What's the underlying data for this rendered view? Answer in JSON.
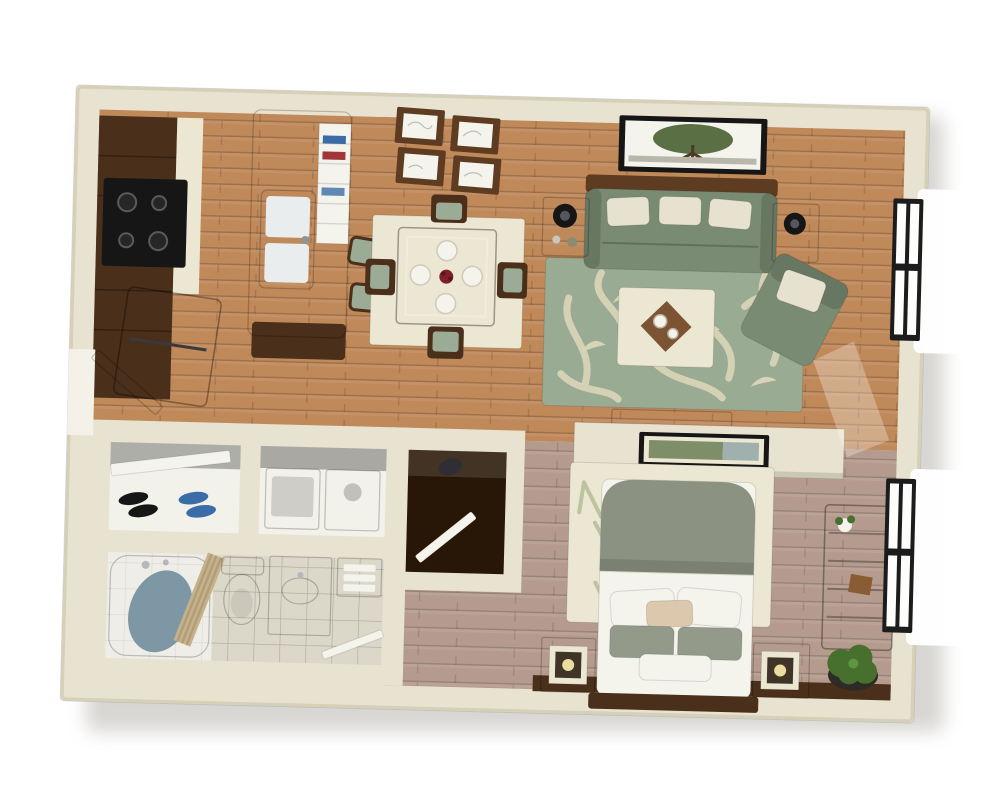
{
  "meta": {
    "title": "3D floor plan render of a studio apartment, top-down isometric view",
    "view": "top-down 3d cutaway",
    "background": "#ffffff"
  },
  "palette": {
    "wall_face": "#e8e3d0",
    "wall_edge": "#d6d0b9",
    "shadow": "#9a948a",
    "wood_floor": "#c0895a",
    "wood_floor_line": "#a2724a",
    "bedroom_floor": "#b49b8d",
    "bedroom_floor_line": "#9f8675",
    "tile_floor": "#dbd7c9",
    "tile_line": "#c3bdac",
    "closet_white": "#f2f1ea",
    "closet_dark": "#281706",
    "dark_wood": "#4a2f1a",
    "walnut": "#5e3c22",
    "black": "#161616",
    "steel": "#b4b8ba",
    "white": "#f4f3ec",
    "sage": "#7a8b73",
    "sage_light": "#9cab95",
    "rug_green": "#9aab93",
    "flourish_cream": "#d9d4b6",
    "cream_surface": "#ece7d2",
    "pillow_cream": "#e6e2cf",
    "comforter_green": "#8b9282",
    "pillow_sage": "#939a8a",
    "pillow_tan": "#dbc8ad",
    "table_brown": "#7c5434",
    "red_accent": "#7e1f2a",
    "plant_green": "#47702f",
    "art_green": "#5a7044",
    "leaf_soft": "#bcc49f",
    "water_blue": "#7e97a5",
    "curtain_tan": "#c5b28c",
    "curtain_stripe": "#b19d76",
    "vanity_dark": "#615950",
    "gray_appliance": "#cfd2d3",
    "shelf_gray": "#a8a69e",
    "lamp_glow": "#eadb9f",
    "bag_dark": "#2e2e34",
    "book_blue": "#3a6da8",
    "book_red": "#a23636",
    "window_black": "#1c1c1c"
  },
  "scene": {
    "type": "3d-floor-plan",
    "subject": "studio apartment",
    "rooms": [
      {
        "name": "kitchen",
        "items": [
          "dark-wood-cabinets",
          "black-stove-four-burners",
          "black-refrigerator",
          "island-with-double-sink",
          "island-open-shelf",
          "two-bar-stools"
        ]
      },
      {
        "name": "dining-area",
        "items": [
          "square-wood-table",
          "four-chairs-sage-cushions",
          "four-place-settings",
          "red-centerpiece",
          "cream-area-rug",
          "four-framed-prints-on-wall"
        ]
      },
      {
        "name": "living-room",
        "items": [
          "sage-sofa-three-pillows",
          "tree-landscape-framed-art",
          "two-side-tables-with-lamps",
          "sage-scroll-pattern-rug",
          "cream-coffee-table-with-tray",
          "sage-armchair-with-pillow",
          "media-console-on-divider",
          "window-double-casement"
        ]
      },
      {
        "name": "entry",
        "items": [
          "entry-door-open",
          "shoe-closet-with-sliding-door",
          "two-pairs-of-shoes"
        ]
      },
      {
        "name": "laundry-closet",
        "items": [
          "washer",
          "dryer"
        ]
      },
      {
        "name": "bathroom",
        "items": [
          "bathtub-with-water",
          "striped-shower-curtain",
          "toilet",
          "dark-vanity-with-oval-sink",
          "towel-shelf",
          "door-open",
          "tile-floor"
        ]
      },
      {
        "name": "walk-in-closet",
        "items": [
          "dark-interior",
          "open-white-door",
          "bag"
        ]
      },
      {
        "name": "bedroom",
        "items": [
          "double-bed-sage-comforter",
          "pillow-stack",
          "leaf-pattern-rug",
          "two-nightstands-with-cube-lamps",
          "dark-headboard",
          "long-dresser-with-flowers",
          "potted-plant",
          "half-wall-divider-with-framed-art",
          "window-double-casement"
        ]
      }
    ],
    "window_count": 2,
    "door_count": 4
  }
}
